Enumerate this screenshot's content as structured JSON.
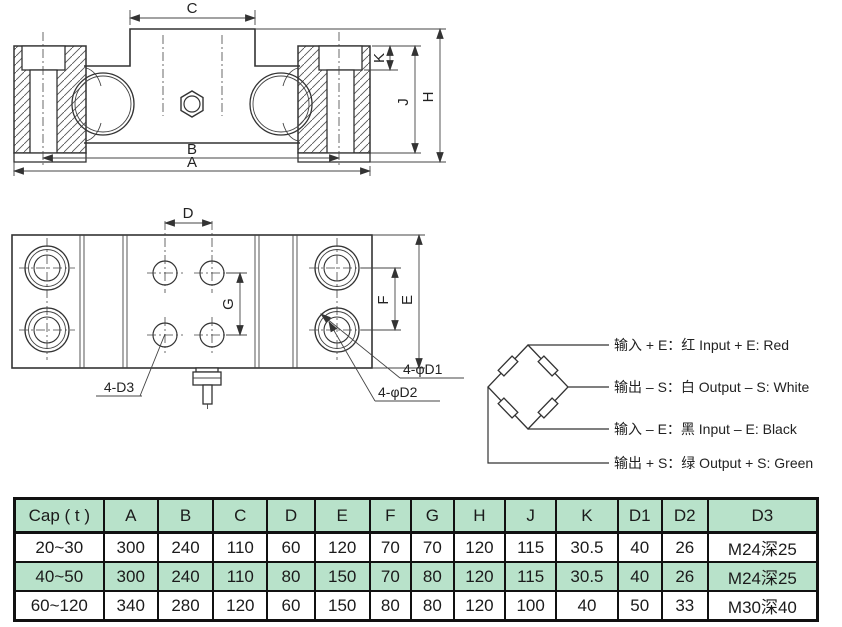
{
  "front_view": {
    "dim_labels": {
      "c": "C",
      "k": "K",
      "j": "J",
      "h": "H",
      "b": "B",
      "a": "A"
    }
  },
  "plan_view": {
    "dim_labels": {
      "d": "D",
      "g": "G",
      "f": "F",
      "e": "E"
    },
    "callouts": {
      "d3": "4-D3",
      "d1": "4-φD1",
      "d2": "4-φD2"
    }
  },
  "wiring_diagram": {
    "labels": [
      "输入 + E：红 Input + E: Red",
      "输出 – S：白 Output – S: White",
      "输入 – E：黑 Input – E: Black",
      "输出 + S：绿 Output + S: Green"
    ]
  },
  "spec_table": {
    "headers": [
      "Cap ( t )",
      "A",
      "B",
      "C",
      "D",
      "E",
      "F",
      "G",
      "H",
      "J",
      "K",
      "D1",
      "D2",
      "D3"
    ],
    "rows": [
      [
        "20~30",
        "300",
        "240",
        "110",
        "60",
        "120",
        "70",
        "70",
        "120",
        "115",
        "30.5",
        "40",
        "26",
        "M24深25"
      ],
      [
        "40~50",
        "300",
        "240",
        "110",
        "80",
        "150",
        "70",
        "80",
        "120",
        "115",
        "30.5",
        "40",
        "26",
        "M24深25"
      ],
      [
        "60~120",
        "340",
        "280",
        "120",
        "60",
        "150",
        "80",
        "80",
        "120",
        "100",
        "40",
        "50",
        "33",
        "M30深40"
      ]
    ],
    "style": {
      "green": "#b8e2ca",
      "white": "#ffffff"
    }
  }
}
